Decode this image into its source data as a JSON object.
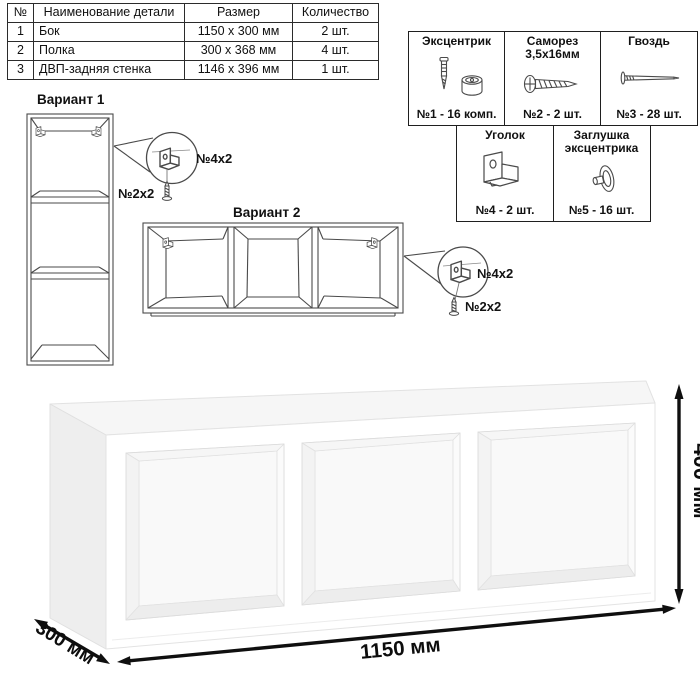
{
  "parts_table": {
    "headers": [
      "№",
      "Наименование детали",
      "Размер",
      "Количество"
    ],
    "rows": [
      {
        "num": "1",
        "name": "Бок",
        "size": "1150 x 300 мм",
        "qty": "2 шт."
      },
      {
        "num": "2",
        "name": "Полка",
        "size": "300 x 368 мм",
        "qty": "4 шт."
      },
      {
        "num": "3",
        "name": "ДВП-задняя стенка",
        "size": "1146 x 396 мм",
        "qty": "1 шт."
      }
    ]
  },
  "hardware": {
    "items": [
      {
        "name": "Эксцентрик",
        "qty": "№1 - 16 комп.",
        "icon": "cam-bolt-icon"
      },
      {
        "name": "Саморез 3,5х16мм",
        "qty": "№2 - 2 шт.",
        "icon": "screw-icon"
      },
      {
        "name": "Гвоздь",
        "qty": "№3 - 28 шт.",
        "icon": "nail-icon"
      },
      {
        "name": "Уголок",
        "qty": "№4 - 2 шт.",
        "icon": "corner-bracket-icon"
      },
      {
        "name": "Заглушка эксцентрика",
        "qty": "№5 - 16 шт.",
        "icon": "cam-cap-icon"
      }
    ]
  },
  "variants": {
    "variant1_label": "Вариант 1",
    "variant2_label": "Вариант 2",
    "bracket_label": "№4х2",
    "screw_label": "№2х2"
  },
  "dimensions": {
    "width": "1150 мм",
    "depth": "300 мм",
    "height": "400 мм"
  },
  "colors": {
    "line": "#4a4a4a",
    "dimension": "#0d0d0d",
    "shade_left": "#efefef",
    "shade_top": "#f6f6f6"
  }
}
